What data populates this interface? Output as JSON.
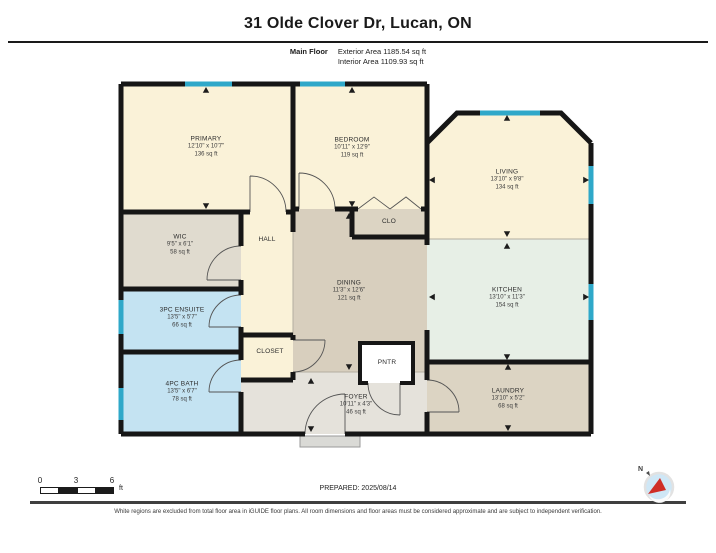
{
  "header": {
    "title": "31 Olde Clover Dr, Lucan, ON",
    "floor_label": "Main Floor",
    "exterior_area": "Exterior Area 1185.54 sq ft",
    "interior_area": "Interior Area 1109.93 sq ft"
  },
  "rooms": [
    {
      "id": "primary",
      "name": "PRIMARY",
      "dims": "12'10\" x 10'7\"",
      "area": "136 sq ft"
    },
    {
      "id": "bedroom",
      "name": "BEDROOM",
      "dims": "10'11\" x 12'9\"",
      "area": "119 sq ft"
    },
    {
      "id": "living",
      "name": "LIVING",
      "dims": "13'10\" x 9'8\"",
      "area": "134 sq ft"
    },
    {
      "id": "wic",
      "name": "WIC",
      "dims": "9'5\" x 6'1\"",
      "area": "58 sq ft"
    },
    {
      "id": "hall",
      "name": "HALL"
    },
    {
      "id": "clo",
      "name": "CLO"
    },
    {
      "id": "dining",
      "name": "DINING",
      "dims": "11'3\" x 12'6\"",
      "area": "121 sq ft"
    },
    {
      "id": "kitchen",
      "name": "KITCHEN",
      "dims": "13'10\" x 11'3\"",
      "area": "154 sq ft"
    },
    {
      "id": "ensuite",
      "name": "3PC ENSUITE",
      "dims": "13'5\" x 5'7\"",
      "area": "66 sq ft"
    },
    {
      "id": "bath",
      "name": "4PC BATH",
      "dims": "13'5\" x 6'7\"",
      "area": "78 sq ft"
    },
    {
      "id": "closet",
      "name": "CLOSET"
    },
    {
      "id": "pntr",
      "name": "PNTR"
    },
    {
      "id": "foyer",
      "name": "FOYER",
      "dims": "10'11\" x 4'3\"",
      "area": "46 sq ft"
    },
    {
      "id": "laundry",
      "name": "LAUNDRY",
      "dims": "13'10\" x 5'2\"",
      "area": "68 sq ft"
    }
  ],
  "scale_bar": {
    "ticks": [
      "0",
      "3",
      "6"
    ],
    "unit": "ft"
  },
  "compass": {
    "north_label": "N"
  },
  "footer": {
    "prepared": "PREPARED: 2025/08/14",
    "disclaimer": "White regions are excluded from total floor area in iGUIDE floor plans. All room dimensions and floor areas must be considered approximate and are subject to independent verification."
  },
  "colors": {
    "wall": "#161616",
    "window": "#2fa8c9",
    "room_cream": "#faf2d8",
    "room_tan": "#dcd4c3",
    "room_dining": "#d8cfbe",
    "room_gray": "#e0dbcf",
    "room_blue": "#c4e3f2",
    "room_mint": "#e7efe6",
    "room_foyer": "#e5e2db",
    "compass_fill": "#cfe7f6",
    "compass_needle": "#cf2e27"
  }
}
